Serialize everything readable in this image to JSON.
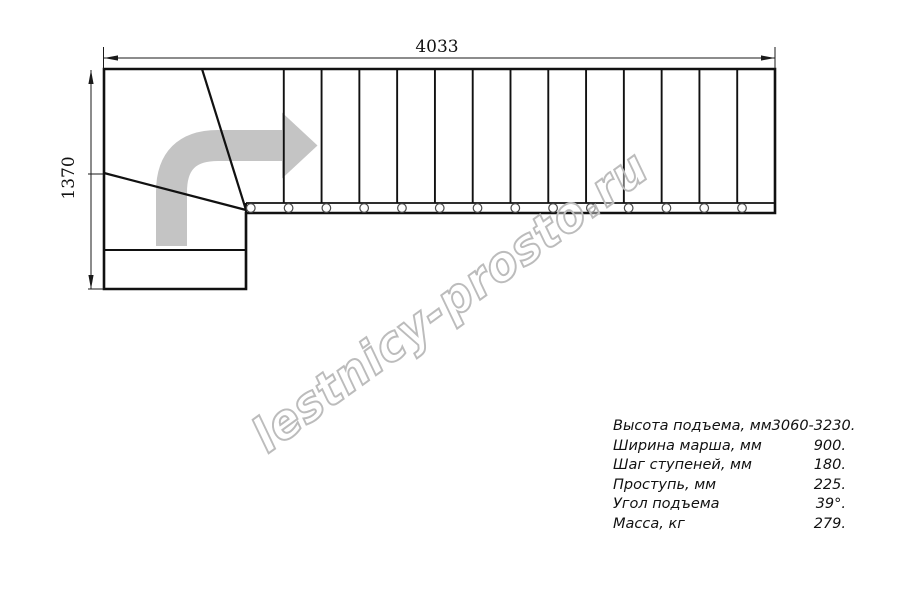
{
  "drawing": {
    "dimensions": {
      "total_length": "4033",
      "total_width": "1370"
    },
    "flight": {
      "steps": 14,
      "balusters": 14,
      "winder_treads": 3
    },
    "colors": {
      "line": "#111111",
      "arrow": "#c4c4c4",
      "watermark_outline": "#bcbcbc"
    }
  },
  "watermark": {
    "text": "lestnicy-prosto.ru"
  },
  "specs": {
    "rows": [
      {
        "label": "Высота подъема, мм",
        "value": "3060-3230."
      },
      {
        "label": "Ширина марша, мм",
        "value": "900."
      },
      {
        "label": "Шаг ступеней, мм",
        "value": "180."
      },
      {
        "label": "Проступь, мм",
        "value": "225."
      },
      {
        "label": "Угол подъема",
        "value": "39°."
      },
      {
        "label": "Масса, кг",
        "value": "279."
      }
    ]
  }
}
